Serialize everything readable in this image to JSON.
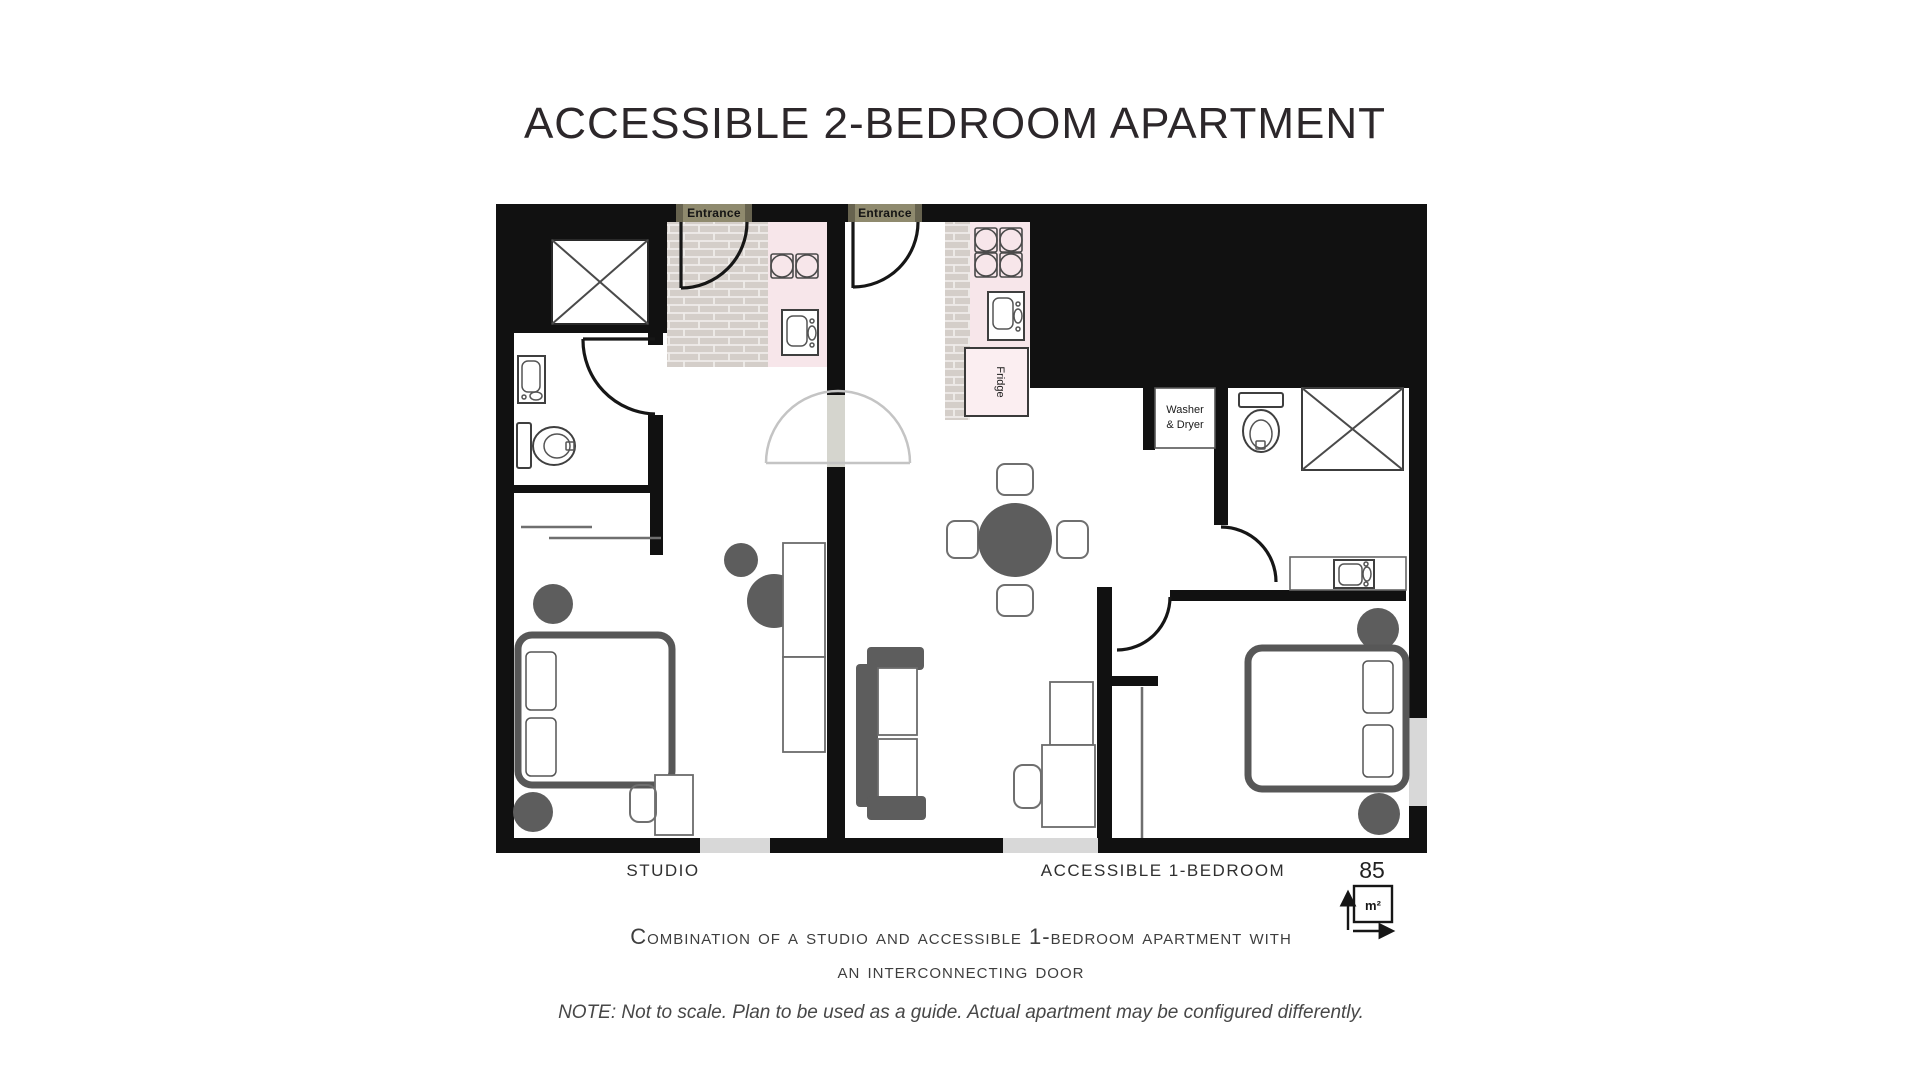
{
  "title": "ACCESSIBLE 2-BEDROOM APARTMENT",
  "plan": {
    "entrance_label": "Entrance",
    "fridge_label": "Fridge",
    "washer_label_line1": "Washer",
    "washer_label_line2": "& Dryer"
  },
  "footer": {
    "unit_left_label": "STUDIO",
    "unit_right_label": "ACCESSIBLE 1-BEDROOM",
    "area_value": "85",
    "area_unit": "m²",
    "caption_line1": "Combination of a studio and accessible 1-bedroom apartment with",
    "caption_line2": "an interconnecting door",
    "note": "NOTE: Not to scale. Plan to be used as a guide. Actual apartment may be configured differently."
  },
  "colors": {
    "wall_black": "#111111",
    "kitchen_pink": "#f7e6ea",
    "brick_gray": "#d4cec9",
    "entrance_olive": "#8f8a6e",
    "entrance_post_olive": "#67634f",
    "furniture_gray": "#5d5d5d",
    "window_gray": "#d8d8d8",
    "opening_gray": "#d5d5ce"
  },
  "icons": {
    "area_icon": "square-meter-dimension-arrows",
    "door_icon": "door-swing-arc",
    "shower_icon": "crossed-box-shower",
    "toilet_icon": "toilet-tank-and-bowl",
    "sink_icon": "basin-with-faucet",
    "burner_icon": "stove-burner-circle-in-square"
  }
}
